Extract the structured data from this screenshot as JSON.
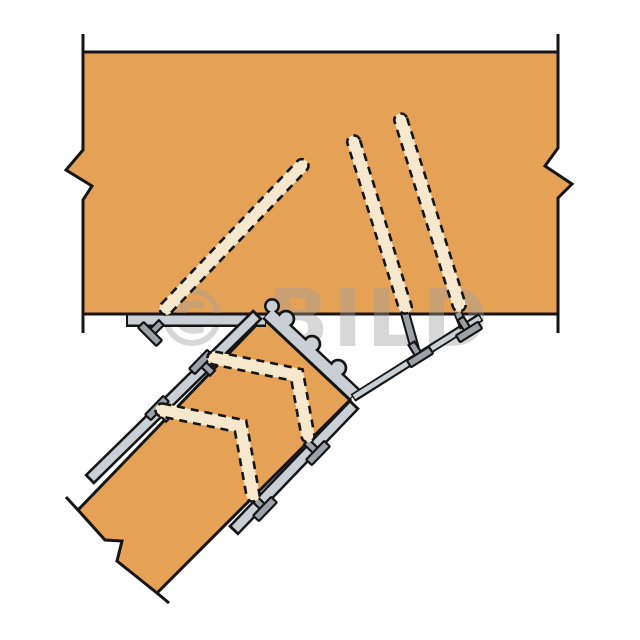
{
  "figure": {
    "watermark_text": "© BILD",
    "parts": {
      "header_beam": "horizontal timber header (broken-out section)",
      "joist": "sloped timber joist (broken-out section)",
      "hanger": "adjustable skew joist hanger with scalloped seat",
      "top_flange": "hanger flange nailed under header",
      "diagonal_strap": "hanger strap anchored to header soffit",
      "hidden_nails_header": 3,
      "hidden_nails_joist": 2,
      "nail_heads": 7
    }
  },
  "colors": {
    "wood": "#E5A257",
    "ink": "#151515",
    "metal_light": "#C9CFD4",
    "metal_mid": "#9CA2A8",
    "nail_hidden": "#F6E8CC",
    "watermark": "#9E9E9E",
    "background": "#FFFFFF"
  }
}
